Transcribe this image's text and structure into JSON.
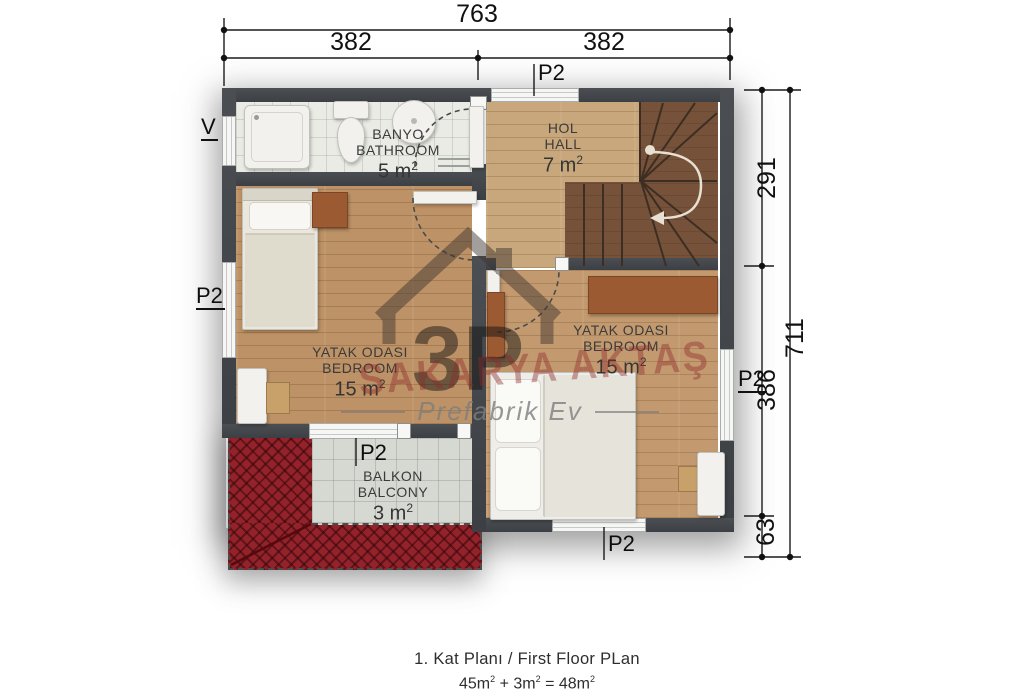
{
  "dimensions": {
    "top_total": "763",
    "top_left": "382",
    "top_right": "382",
    "right_top": "291",
    "right_total": "711",
    "right_mid": "386",
    "right_bottom": "63"
  },
  "labels": {
    "window": "P2",
    "vent": "V"
  },
  "rooms": {
    "bathroom": {
      "name_tr": "BANYO",
      "name_en": "BATHROOM",
      "area": "5 m",
      "sup": "2"
    },
    "hall": {
      "name_tr": "HOL",
      "name_en": "HALL",
      "area": "7 m",
      "sup": "2"
    },
    "bedroom_left": {
      "name_tr": "YATAK ODASI",
      "name_en": "BEDROOM",
      "area": "15 m",
      "sup": "2"
    },
    "bedroom_right": {
      "name_tr": "YATAK ODASI",
      "name_en": "BEDROOM",
      "area": "15 m",
      "sup": "2"
    },
    "balcony": {
      "name_tr": "BALKON",
      "name_en": "BALCONY",
      "area": "3 m",
      "sup": "2"
    }
  },
  "caption": {
    "line1": "1. Kat Planı / First Floor PLan",
    "t1": "45m",
    "plus": "+",
    "t2": "3m",
    "eq": "=",
    "t3": "48m",
    "sup": "2"
  },
  "watermark": {
    "logo": "3P",
    "brand": "SAKARYA AKTAŞ",
    "tagline": "Prefabrik Ev"
  },
  "colors": {
    "wall": "#42464a",
    "wood_floor": "#bd9266",
    "hall_floor": "#c8a77c",
    "stairs": "#77523a",
    "bath_tile": "#e9ebe4",
    "balcony_tile": "#d6d8d2",
    "roof_red": "#93222a",
    "dimension_ink": "#111111",
    "watermark_red": "#8d2a2a"
  }
}
